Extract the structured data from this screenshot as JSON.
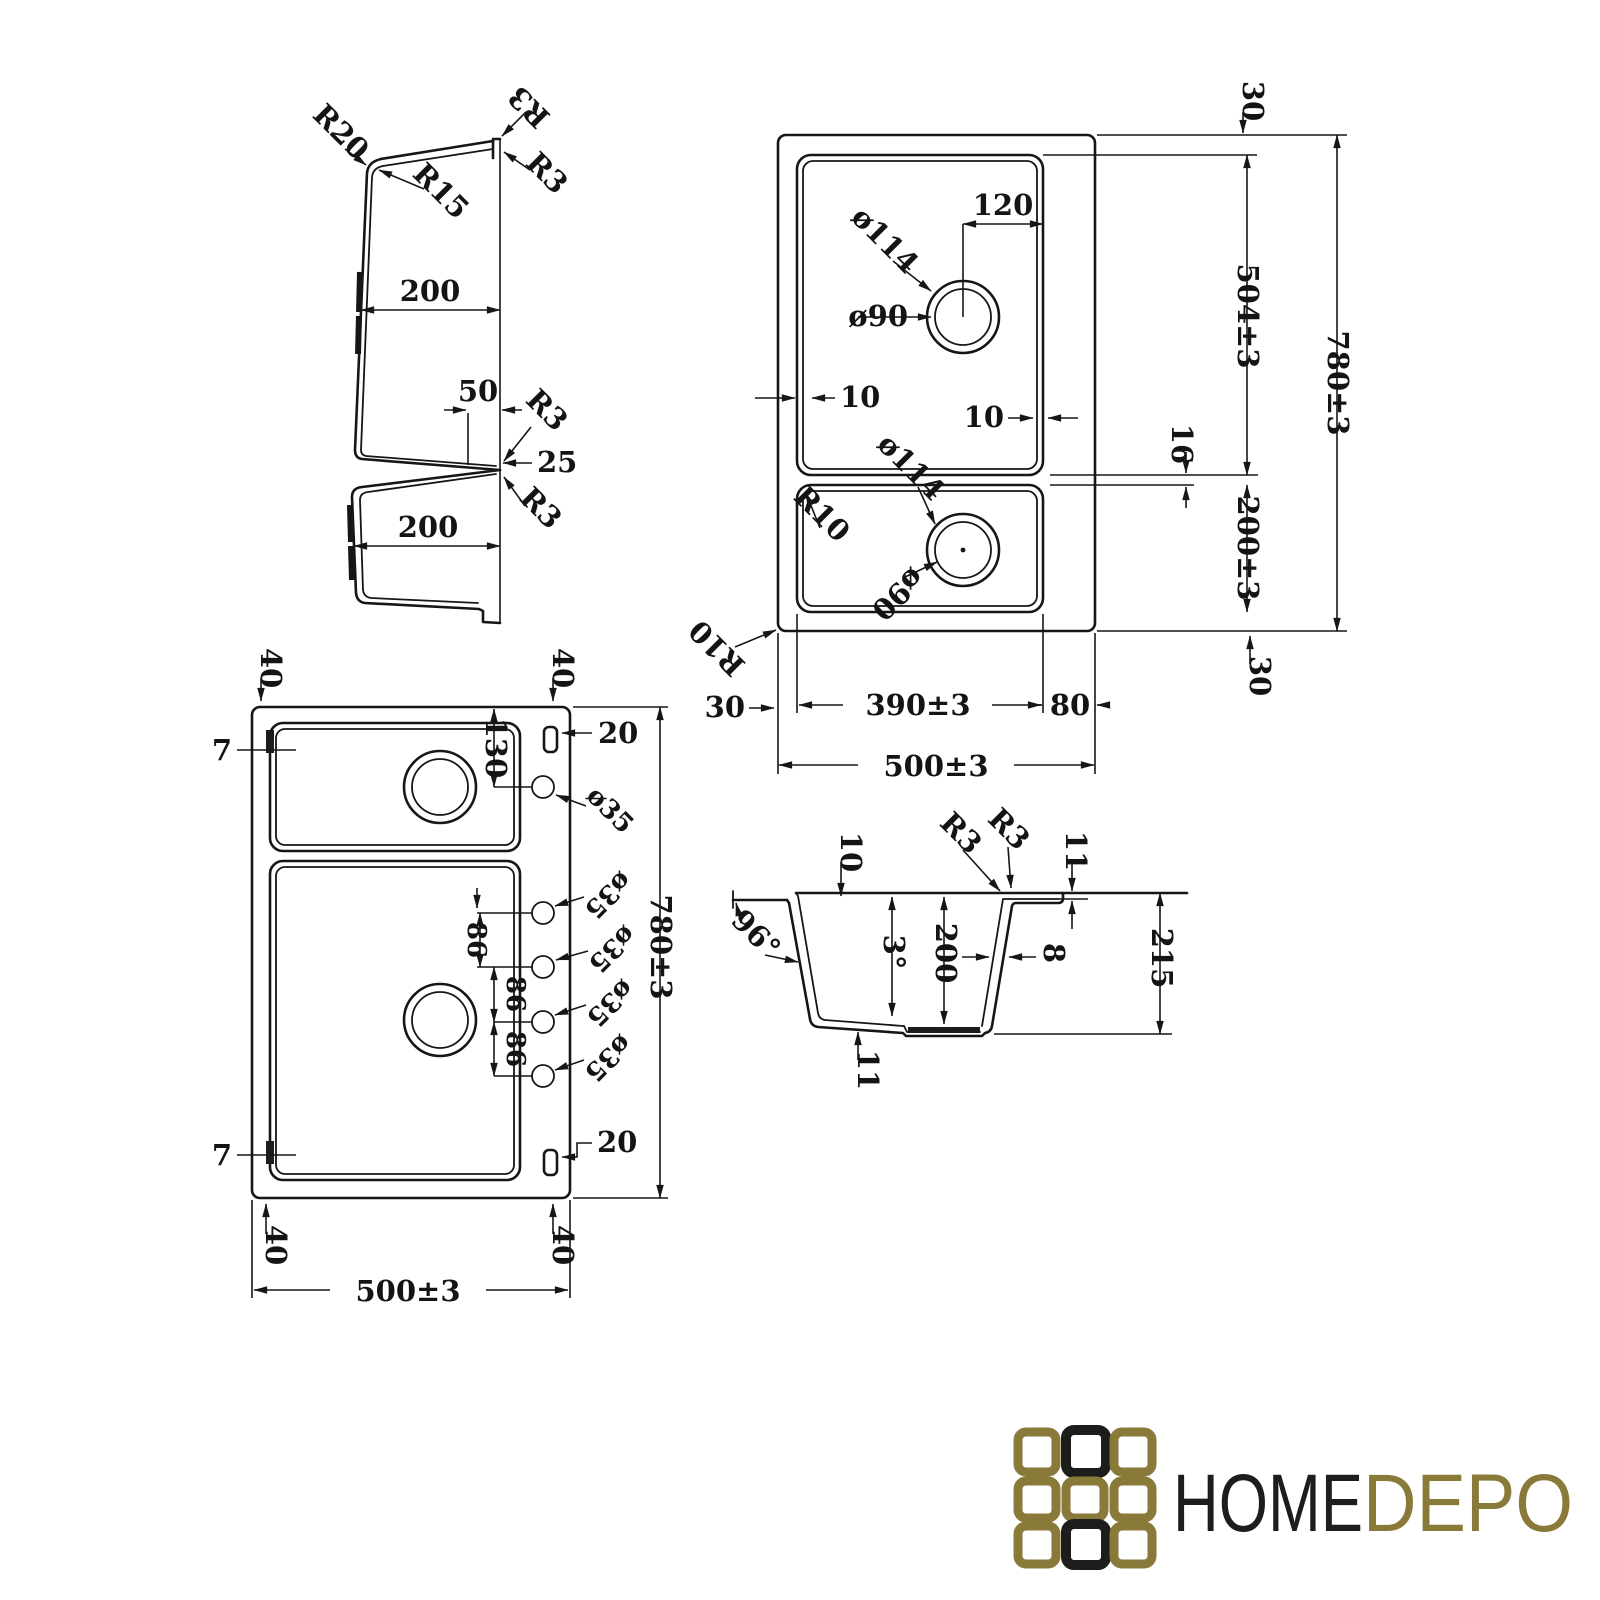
{
  "drawing": {
    "profile_view": {
      "r20": "R20",
      "r3_step_top": "R3",
      "r15": "R15",
      "r3_step_side": "R3",
      "upper_bowl_width": "200",
      "divider_width": "50",
      "r3_divider_upper": "R3",
      "divider_depth": "25",
      "r3_divider_lower": "R3",
      "lower_bowl_width": "200"
    },
    "plan_view": {
      "top_rim": "30",
      "upper_bowl_length": "504±3",
      "overall_length": "780±3",
      "drain_offset": "120",
      "drain_top_outer": "ø114",
      "drain_top_inner": "ø90",
      "left_rim_thickness": "10",
      "right_rim_thickness": "10",
      "divider_thickness": "16",
      "lower_bowl_length": "200±3",
      "drain_bottom_outer": "ø114",
      "drain_bottom_inner": "ø90",
      "inner_corner_radius": "R10",
      "outer_corner_radius": "R10",
      "bottom_left_rim": "30",
      "bowl_width": "390±3",
      "right_deck_width": "80",
      "overall_width": "500±3",
      "bottom_rim": "30"
    },
    "drilling_view": {
      "corner_offset_top_left": "40",
      "corner_offset_top_right": "40",
      "clip_tab_top": "7",
      "slot_top": "20",
      "first_hole_offset": "130",
      "hole_1": "ø35",
      "hole_2": "ø35",
      "hole_3": "ø35",
      "hole_4": "ø35",
      "hole_5": "ø35",
      "hole_spacing_1": "86",
      "hole_spacing_2": "86",
      "hole_spacing_3": "86",
      "overall_length": "780±3",
      "slot_bottom": "20",
      "clip_tab_bottom": "7",
      "corner_offset_bottom_left": "40",
      "corner_offset_bottom_right": "40",
      "overall_width": "500±3"
    },
    "section_view": {
      "ledge_depth": "10",
      "r3_inner": "R3",
      "r3_outer": "R3",
      "lip_height": "11",
      "wall_angle": "96°",
      "bottom_slope": "3°",
      "bowl_depth": "200",
      "wall_thickness": "8",
      "overall_depth": "215",
      "bottom_drop": "11"
    }
  },
  "logo": {
    "name_primary": "HOME",
    "name_secondary": "DEPO",
    "black_hex": "#1d1d1b",
    "gold_hex": "#8a7a3a",
    "square_colors": [
      "#8a7a3a",
      "#1d1d1b",
      "#8a7a3a",
      "#8a7a3a",
      "#8a7a3a",
      "#8a7a3a",
      "#8a7a3a",
      "#1d1d1b",
      "#8a7a3a"
    ]
  }
}
